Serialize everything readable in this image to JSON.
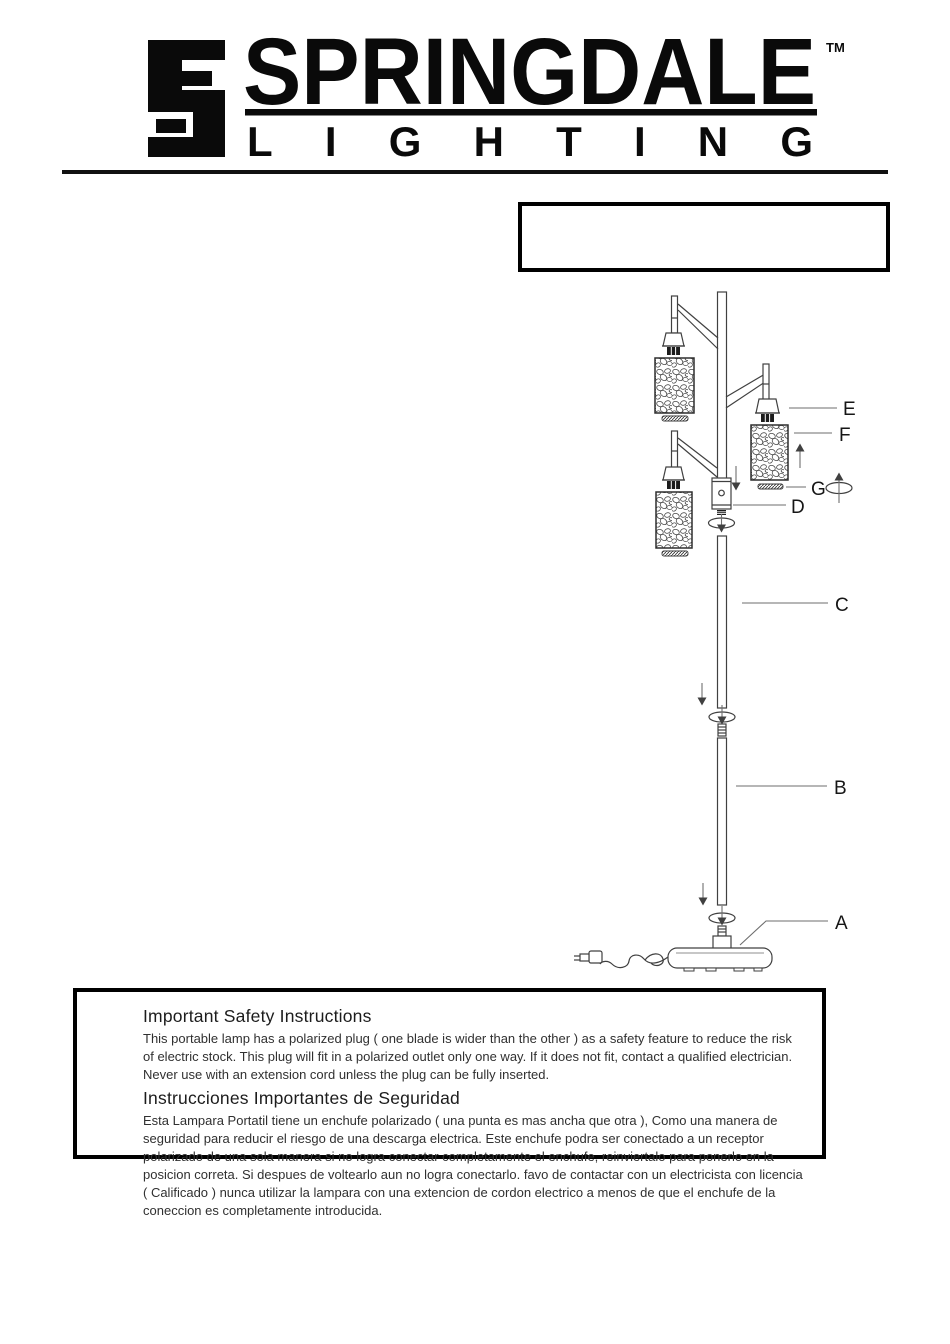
{
  "brand": {
    "name": "SPRINGDALE",
    "tm": "TM",
    "subtitle": "LIGHTING"
  },
  "model_box": {
    "text": ""
  },
  "diagram": {
    "labels": {
      "A": "A",
      "B": "B",
      "C": "C",
      "D": "D",
      "E": "E",
      "F": "F",
      "G": "G"
    }
  },
  "safety": {
    "en_title": "Important Safety Instructions",
    "en_body": "This portable lamp has a polarized plug ( one blade is wider than the other ) as a safety feature to reduce the risk of electric stock. This plug will fit in a polarized outlet only one way. If it does not fit, contact a qualified electrician. Never use with an extension cord unless the plug can be fully inserted.",
    "es_title": "Instrucciones Importantes de Seguridad",
    "es_body": "Esta Lampara Portatil tiene un enchufe polarizado ( una punta es mas ancha que otra ), Como una manera de seguridad para reducir el riesgo de una descarga electrica. Este enchufe podra ser conectado a un receptor polarizado de una sola manera si no logra conectar completamente el enchufe, reinviertalo para ponerlo en la posicion correta. Si despues de voltearlo aun no logra conectarlo. favo de contactar con un electricista con licencia ( Calificado ) nunca utilizar la lampara con una extencion de cordon electrico a menos de que el enchufe de la coneccion es completamente introducida."
  }
}
